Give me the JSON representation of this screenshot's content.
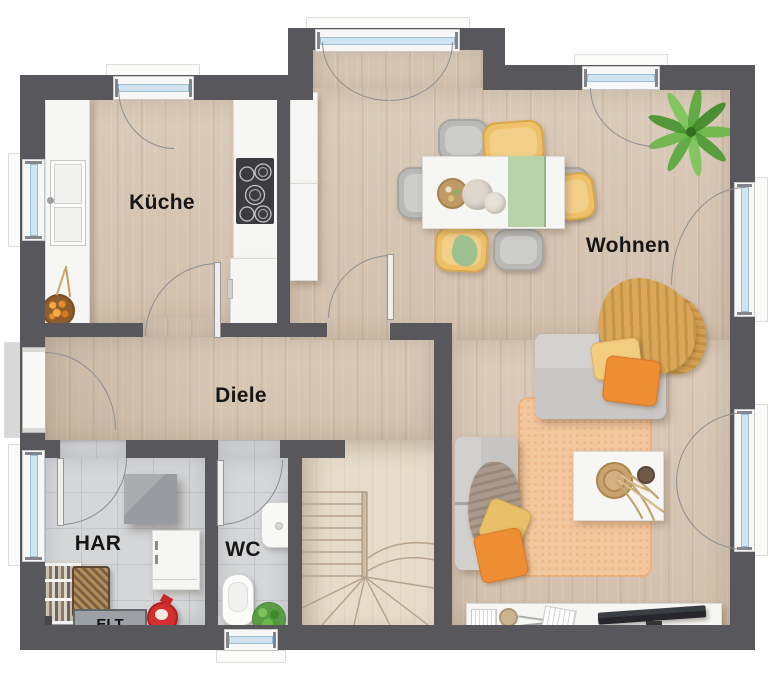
{
  "plan": {
    "type_label": "floor-plan",
    "rooms": [
      {
        "id": "kueche",
        "label": "Küche"
      },
      {
        "id": "wohnen",
        "label": "Wohnen"
      },
      {
        "id": "diele",
        "label": "Diele"
      },
      {
        "id": "har",
        "label": "HAR"
      },
      {
        "id": "wc",
        "label": "WC"
      },
      {
        "id": "elt",
        "label": "ELT"
      }
    ],
    "colors": {
      "wall": "#58585c",
      "wood_floor": "#d9c8b6",
      "tile_floor": "#d4d6d8",
      "stair_wood": "#e7dccb",
      "window_glass": "#cfe6f2",
      "sofa_gray": "#c6c5c3",
      "accent_yellow": "#eec169",
      "accent_orange": "#ef8d33",
      "runner_green": "#b9d3a9",
      "rug_peach": "#f3c79e",
      "plant_green": "#63b23f",
      "red_item": "#d32f2f"
    }
  }
}
